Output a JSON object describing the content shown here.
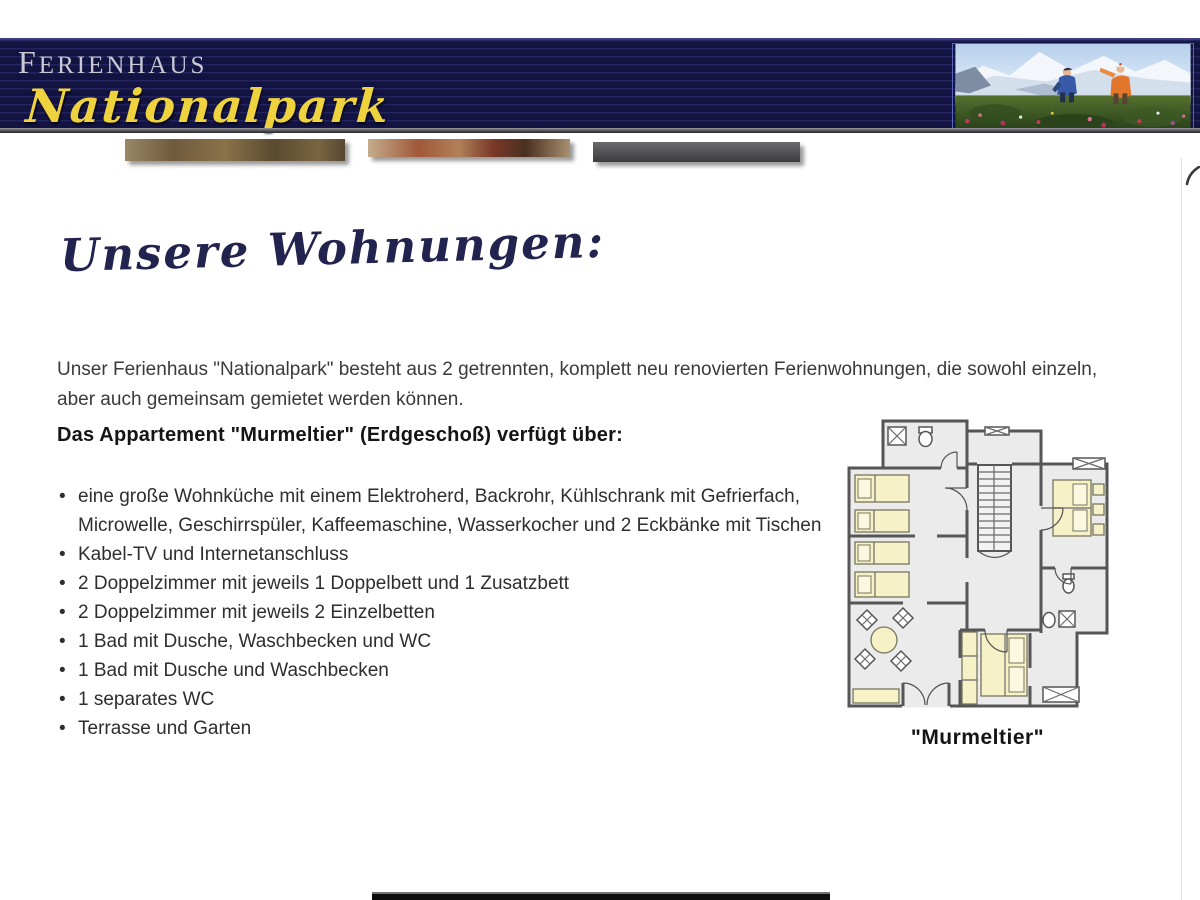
{
  "header": {
    "brand_top": "Ferienhaus",
    "brand_main": "Nationalpark",
    "colors": {
      "background": "#131342",
      "pinstripe": "#23235e",
      "brand_top_text": "#c9c9d6",
      "brand_main_text": "#eed23e"
    }
  },
  "content": {
    "script_heading": "Unsere Wohnungen:",
    "intro_paragraph": "Unser Ferienhaus \"Nationalpark\" besteht aus 2 getrennten, komplett neu renovierten Ferienwohnungen, die sowohl einzeln, aber auch gemeinsam gemietet werden können.",
    "apartment_heading": "Das Appartement \"Murmeltier\" (Erdgeschoß) verfügt über:",
    "features": [
      "eine große Wohnküche mit einem Elektroherd, Backrohr, Kühlschrank mit Gefrierfach, Microwelle, Geschirrspüler, Kaffeemaschine, Wasserkocher und 2 Eckbänke mit Tischen",
      "Kabel-TV und Internetanschluss",
      "2 Doppelzimmer mit jeweils 1 Doppelbett und 1 Zusatzbett",
      "2 Doppelzimmer mit jeweils 2 Einzelbetten",
      "1 Bad mit Dusche, Waschbecken und WC",
      "1 Bad mit Dusche und Waschbecken",
      "1 separates WC",
      "Terrasse und Garten"
    ],
    "floorplan_caption": "\"Murmeltier\""
  }
}
